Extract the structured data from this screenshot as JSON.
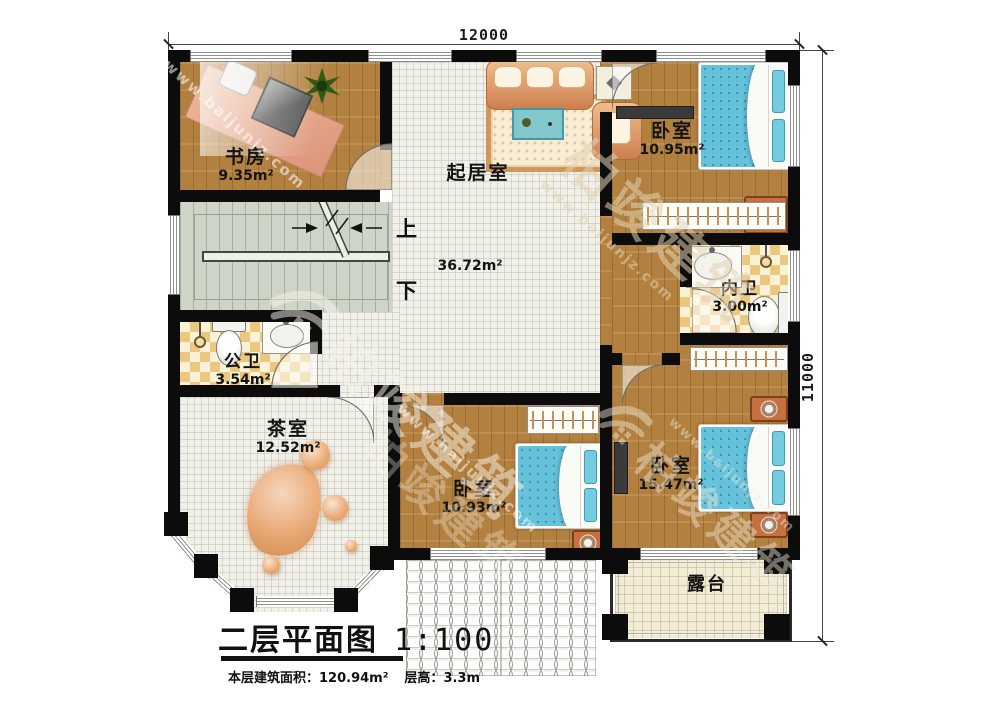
{
  "title_block": {
    "title": "二层平面图",
    "scale": "1:100",
    "area_label": "本层建筑面积：",
    "area_value": "120.94m²",
    "height_label": "层高：",
    "height_value": "3.3m"
  },
  "dimensions": {
    "width": "12000",
    "height": "11000"
  },
  "stairs": {
    "up": "上",
    "down": "下"
  },
  "rooms": {
    "study": {
      "name": "书房",
      "area": "9.35m²"
    },
    "living": {
      "name": "起居室",
      "area": "36.72m²"
    },
    "bedroom_top_right": {
      "name": "卧室",
      "area": "10.95m²"
    },
    "bath_private": {
      "name": "内卫",
      "area": "3.00m²"
    },
    "bath_public": {
      "name": "公卫",
      "area": "3.54m²"
    },
    "tea_room": {
      "name": "茶室",
      "area": "12.52m²"
    },
    "bedroom_bottom_middle": {
      "name": "卧室",
      "area": "10.93m²"
    },
    "bedroom_bottom_right": {
      "name": "卧室",
      "area": "15.47m²"
    },
    "terrace": {
      "name": "露台"
    }
  },
  "watermark": {
    "brand": "柏竣建筑",
    "url": "www.baijunjz.com"
  },
  "colors": {
    "wall": "#0c0c0c",
    "wood_floor": "#b2803f",
    "stair_floor": "#ced4c8",
    "tile_floor": "#ecc87f",
    "terrace_floor": "#f2ecd7",
    "bed_blue": "#67c3db",
    "sofa_tan": "#e0a06a"
  }
}
